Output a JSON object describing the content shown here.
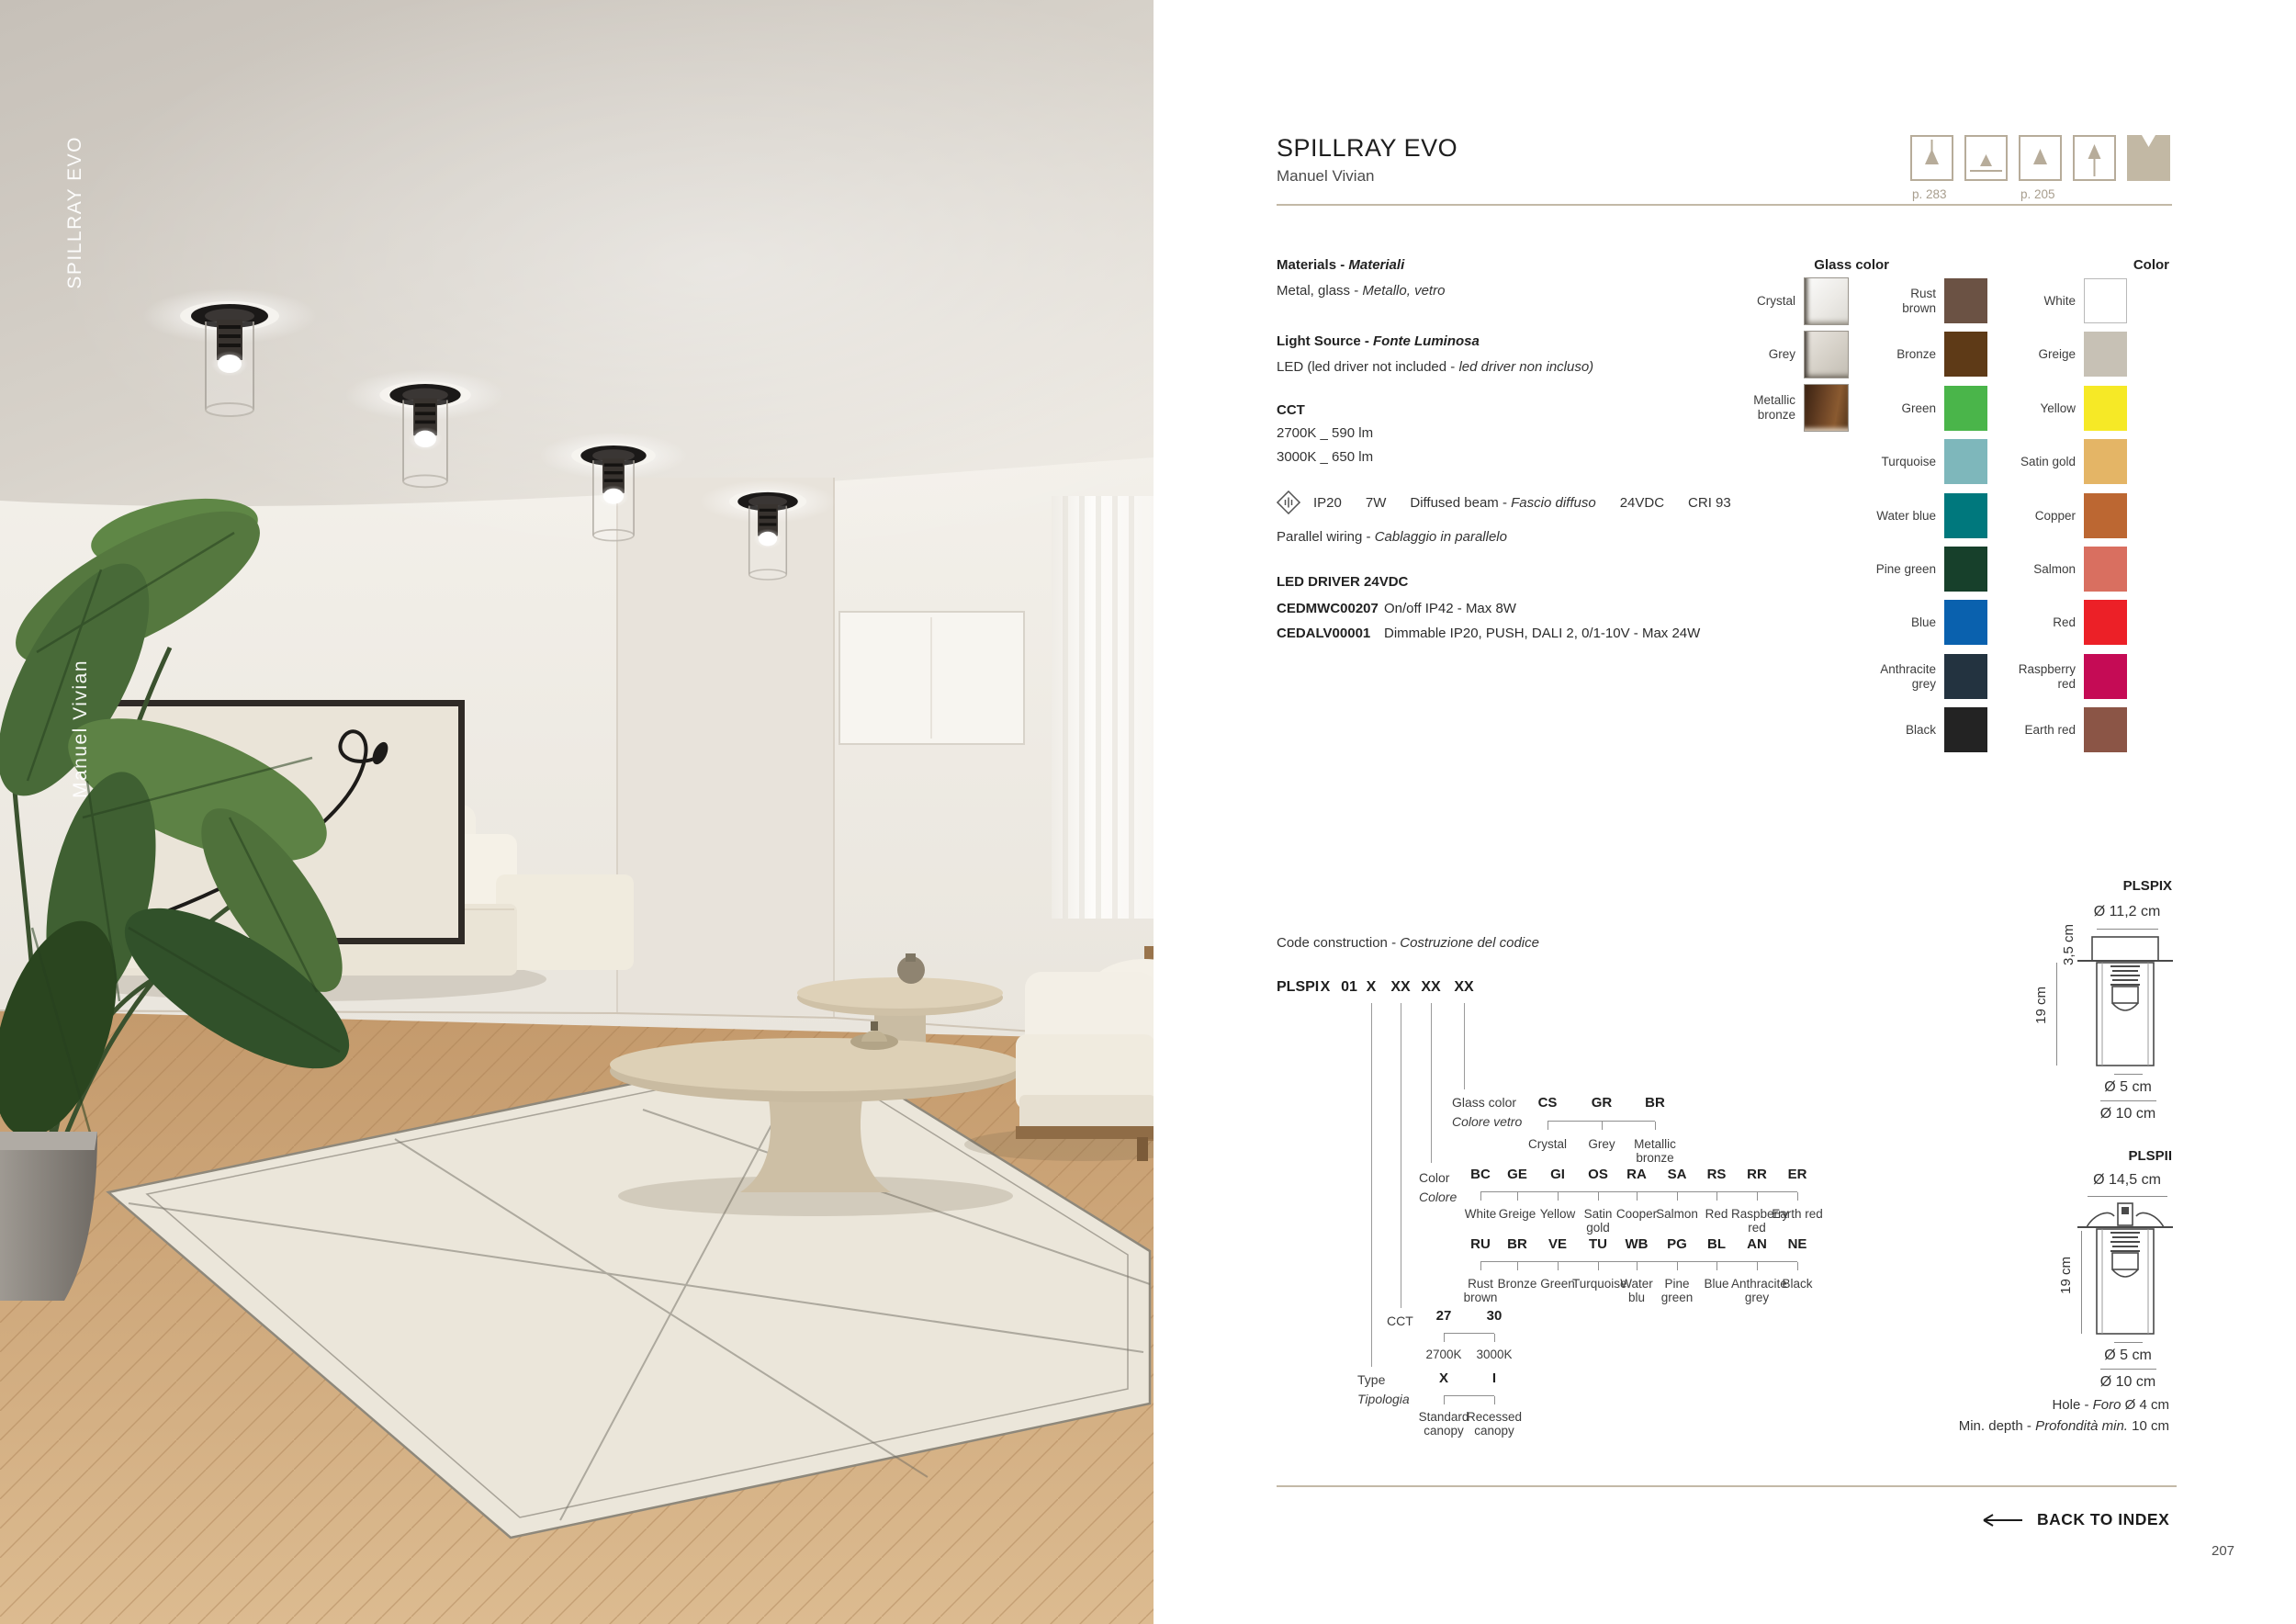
{
  "photo": {
    "vertical_title": "SPILLRAY EVO",
    "vertical_designer": "Manuel Vivian"
  },
  "header": {
    "title": "SPILLRAY EVO",
    "designer": "Manuel Vivian",
    "variants": {
      "pendant_page": "p. 283",
      "spot_page": "p. 205"
    }
  },
  "specs": {
    "materials_en": "Materials - ",
    "materials_it": "Materiali",
    "materials_value_en": "Metal, glass - ",
    "materials_value_it": "Metallo, vetro",
    "light_source_en": "Light Source - ",
    "light_source_it": "Fonte Luminosa",
    "light_source_value_en": "LED (led driver not included - ",
    "light_source_value_it": "led driver non incluso)",
    "cct_label": "CCT",
    "cct_values": [
      "2700K _ 590 lm",
      "3000K _ 650 lm"
    ],
    "beam": {
      "ip": "IP20",
      "watt": "7W",
      "beam_en": "Diffused beam - ",
      "beam_it": "Fascio diffuso",
      "voltage": "24VDC",
      "cri": "CRI 93"
    },
    "wiring_en": "Parallel wiring - ",
    "wiring_it": "Cablaggio in parallelo",
    "driver_header": "LED DRIVER 24VDC",
    "drivers": [
      {
        "code": "CEDMWC00207",
        "desc": "On/off IP42 - Max 8W"
      },
      {
        "code": "CEDALV00001",
        "desc": "Dimmable IP20, PUSH, DALI 2, 0/1-10V - Max 24W"
      }
    ]
  },
  "glass_colors": {
    "header": "Glass color",
    "items": [
      {
        "label": "Crystal"
      },
      {
        "label": "Grey"
      },
      {
        "label": "Metallic bronze"
      }
    ]
  },
  "colors": {
    "header": "Color",
    "col1": [
      {
        "label": "Rust brown",
        "hex": "#6B5244"
      },
      {
        "label": "Bronze",
        "hex": "#5E3A17"
      },
      {
        "label": "Green",
        "hex": "#4AB54A"
      },
      {
        "label": "Turquoise",
        "hex": "#7EB7BB"
      },
      {
        "label": "Water blue",
        "hex": "#00787D"
      },
      {
        "label": "Pine green",
        "hex": "#17402B"
      },
      {
        "label": "Blue",
        "hex": "#0A61AE"
      },
      {
        "label": "Anthracite grey",
        "hex": "#233340"
      },
      {
        "label": "Black",
        "hex": "#232323"
      }
    ],
    "col2": [
      {
        "label": "White",
        "hex": "#FFFFFF"
      },
      {
        "label": "Greige",
        "hex": "#C7C1B5"
      },
      {
        "label": "Yellow",
        "hex": "#F6E926"
      },
      {
        "label": "Satin gold",
        "hex": "#E4B566"
      },
      {
        "label": "Copper",
        "hex": "#BC6732"
      },
      {
        "label": "Salmon",
        "hex": "#D96F60"
      },
      {
        "label": "Red",
        "hex": "#EC2027"
      },
      {
        "label": "Raspberry red",
        "hex": "#C50B55"
      },
      {
        "label": "Earth red",
        "hex": "#8B5546"
      }
    ]
  },
  "code": {
    "title_en": "Code construction - ",
    "title_it": "Costruzione del codice",
    "parts": [
      "PLSPI",
      "X",
      "01",
      "X",
      "XX",
      "XX",
      "XX"
    ],
    "glass_row": {
      "label_en": "Glass color",
      "label_it": "Colore vetro",
      "items": [
        {
          "code": "CS",
          "label": "Crystal"
        },
        {
          "code": "GR",
          "label": "Grey"
        },
        {
          "code": "BR",
          "label": "Metallic bronze"
        }
      ]
    },
    "color_row": {
      "label_en": "Color",
      "label_it": "Colore",
      "row1": [
        {
          "code": "BC",
          "label": "White"
        },
        {
          "code": "GE",
          "label": "Greige"
        },
        {
          "code": "GI",
          "label": "Yellow"
        },
        {
          "code": "OS",
          "label": "Satin gold"
        },
        {
          "code": "RA",
          "label": "Cooper"
        },
        {
          "code": "SA",
          "label": "Salmon"
        },
        {
          "code": "RS",
          "label": "Red"
        },
        {
          "code": "RR",
          "label": "Raspberry red"
        },
        {
          "code": "ER",
          "label": "Earth red"
        }
      ],
      "row2": [
        {
          "code": "RU",
          "label": "Rust brown"
        },
        {
          "code": "BR",
          "label": "Bronze"
        },
        {
          "code": "VE",
          "label": "Green"
        },
        {
          "code": "TU",
          "label": "Turquoise"
        },
        {
          "code": "WB",
          "label": "Water blu"
        },
        {
          "code": "PG",
          "label": "Pine green"
        },
        {
          "code": "BL",
          "label": "Blue"
        },
        {
          "code": "AN",
          "label": "Anthracite grey"
        },
        {
          "code": "NE",
          "label": "Black"
        }
      ]
    },
    "cct_row": {
      "label": "CCT",
      "items": [
        {
          "code": "27",
          "label": "2700K"
        },
        {
          "code": "30",
          "label": "3000K"
        }
      ]
    },
    "type_row": {
      "label_en": "Type",
      "label_it": "Tipologia",
      "items": [
        {
          "code": "X",
          "label": "Standard canopy"
        },
        {
          "code": "I",
          "label": "Recessed canopy"
        }
      ]
    }
  },
  "diagrams": {
    "d1": {
      "name": "PLSPIX",
      "dia_top": "Ø 11,2 cm",
      "h_canopy": "3,5 cm",
      "h_body": "19 cm",
      "dia_small": "Ø 5 cm",
      "dia_big": "Ø 10 cm"
    },
    "d2": {
      "name": "PLSPII",
      "dia_top": "Ø 14,5 cm",
      "h_body": "19 cm",
      "dia_small": "Ø 5 cm",
      "dia_big": "Ø 10 cm",
      "hole_en": "Hole - ",
      "hole_it": "Foro",
      "hole_val": " Ø 4 cm",
      "depth_en": "Min. depth - ",
      "depth_it": "Profondità min.",
      "depth_val": " 10 cm"
    }
  },
  "footer": {
    "back_to_index": "BACK TO INDEX",
    "page_number": "207"
  }
}
